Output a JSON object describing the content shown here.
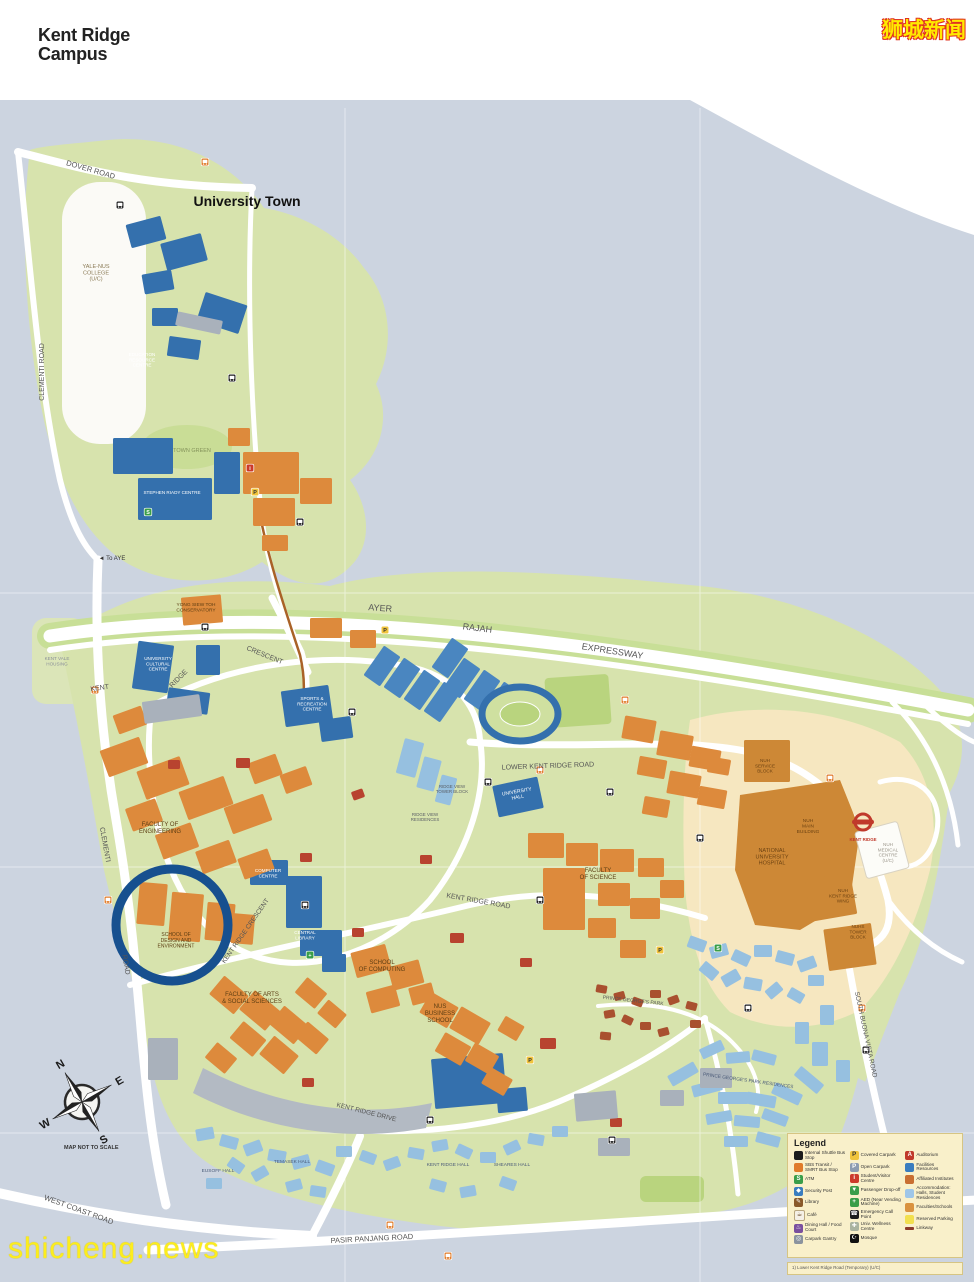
{
  "header": {
    "title_line1": "Kent Ridge",
    "title_line2": "Campus"
  },
  "watermarks": {
    "top_right": "狮城新闻",
    "bottom_left": "shicheng.news"
  },
  "compass": {
    "n": "N",
    "e": "E",
    "w": "W",
    "s": "S",
    "note": "MAP NOT TO SCALE"
  },
  "colors": {
    "water": "#ccd4e0",
    "land_green": "#d7e3ad",
    "field_green": "#b9d47e",
    "nuh_beige": "#f6e7c0",
    "faculty_orange": "#dd8a3c",
    "facility_blue": "#3470ad",
    "residence_blue": "#96c0e0",
    "affiliated_brown": "#cd8836",
    "road_white": "#ffffff",
    "highlight_circle": "#17508f",
    "linkway": "#a96227"
  },
  "map_labels": [
    {
      "t": "University Town",
      "x": 247,
      "y": 206,
      "s": 14,
      "c": "#111111",
      "w": 700
    },
    {
      "t": "DOVER ROAD",
      "x": 90,
      "y": 172,
      "s": 7.5,
      "r": 16,
      "c": "#555555"
    },
    {
      "t": "CLEMENTI ROAD",
      "x": 44,
      "y": 372,
      "s": 7,
      "r": -90,
      "c": "#555555"
    },
    {
      "t": "YALE-NUS\nCOLLEGE\n(U/C)",
      "x": 96,
      "y": 268,
      "s": 5.5,
      "c": "#8a7a55"
    },
    {
      "t": "TOWN GREEN",
      "x": 192,
      "y": 452,
      "s": 5.5,
      "c": "#84935a"
    },
    {
      "t": "STEPHEN RIADY CENTRE",
      "x": 172,
      "y": 494,
      "s": 4.6,
      "c": "#ffffff"
    },
    {
      "t": "EDUCATION\nRESOURCE\nCENTRE",
      "x": 142,
      "y": 356,
      "s": 4.6,
      "c": "#ffffff"
    },
    {
      "t": "YONG SIEW TOH\nCONSERVATORY",
      "x": 196,
      "y": 606,
      "s": 4.8,
      "c": "#5c3d12"
    },
    {
      "t": "◄ To AYE",
      "x": 112,
      "y": 560,
      "s": 6,
      "c": "#333333"
    },
    {
      "t": "AYER",
      "x": 380,
      "y": 611,
      "s": 9,
      "r": 4,
      "c": "#555555"
    },
    {
      "t": "RAJAH",
      "x": 477,
      "y": 631,
      "s": 9,
      "r": 7,
      "c": "#555555"
    },
    {
      "t": "EXPRESSWAY",
      "x": 612,
      "y": 654,
      "s": 9,
      "r": 9,
      "c": "#555555"
    },
    {
      "t": "KENT",
      "x": 100,
      "y": 690,
      "s": 7,
      "r": -8,
      "c": "#555555"
    },
    {
      "t": "RIDGE",
      "x": 180,
      "y": 680,
      "s": 7,
      "r": -45,
      "c": "#555555"
    },
    {
      "t": "CRESCENT",
      "x": 264,
      "y": 657,
      "s": 7,
      "r": 22,
      "c": "#555555"
    },
    {
      "t": "KENT VALE\nHOUSING",
      "x": 57,
      "y": 660,
      "s": 4.6,
      "c": "#8a8f98"
    },
    {
      "t": "UNIVERSITY\nCULTURAL\nCENTRE",
      "x": 158,
      "y": 660,
      "s": 4.6,
      "c": "#ffffff"
    },
    {
      "t": "SPORTS &\nRECREATION\nCENTRE",
      "x": 312,
      "y": 700,
      "s": 4.6,
      "c": "#ffffff"
    },
    {
      "t": "LOWER KENT RIDGE ROAD",
      "x": 548,
      "y": 768,
      "s": 7,
      "r": -2,
      "c": "#555555"
    },
    {
      "t": "UNIVERSITY\nHALL",
      "x": 517,
      "y": 793,
      "s": 5,
      "r": -10,
      "c": "#ffffff"
    },
    {
      "t": "RIDGE VIEW\nTOWER BLOCK",
      "x": 452,
      "y": 788,
      "s": 4.4,
      "c": "#5a5f66"
    },
    {
      "t": "RIDGE VIEW\nRESIDENCES",
      "x": 425,
      "y": 816,
      "s": 4.4,
      "c": "#5a5f66"
    },
    {
      "t": "FACULTY OF\nENGINEERING",
      "x": 160,
      "y": 826,
      "s": 6,
      "c": "#5c3d12"
    },
    {
      "t": "FACULTY\nOF SCIENCE",
      "x": 598,
      "y": 872,
      "s": 6,
      "c": "#5c3d12"
    },
    {
      "t": "NATIONAL\nUNIVERSITY\nHOSPITAL",
      "x": 772,
      "y": 852,
      "s": 5.5,
      "c": "#6e4312"
    },
    {
      "t": "NUH\nMAIN\nBUILDING",
      "x": 808,
      "y": 822,
      "s": 4.8,
      "c": "#6e4312"
    },
    {
      "t": "NUH\nSERVICE\nBLOCK",
      "x": 765,
      "y": 762,
      "s": 4.6,
      "c": "#6e4312"
    },
    {
      "t": "NUH\nMEDICAL\nCENTRE\n(U/C)",
      "x": 888,
      "y": 846,
      "s": 4.6,
      "c": "#9a958a"
    },
    {
      "t": "NUH\nKENT RIDGE\nWING",
      "x": 843,
      "y": 892,
      "s": 4.6,
      "c": "#6e4312"
    },
    {
      "t": "NUHS\nTOWER\nBLOCK",
      "x": 858,
      "y": 928,
      "s": 4.6,
      "c": "#6e4312"
    },
    {
      "t": "KENT RIDGE",
      "x": 863,
      "y": 841,
      "s": 4.4,
      "c": "#c0392b",
      "w": 700
    },
    {
      "t": "SCHOOL OF\nDESIGN AND\nENVIRONMENT",
      "x": 176,
      "y": 936,
      "s": 5,
      "c": "#5c3d12"
    },
    {
      "t": "COMPUTER\nCENTRE",
      "x": 268,
      "y": 872,
      "s": 4.6,
      "c": "#ffffff"
    },
    {
      "t": "CENTRAL\nLIBRARY",
      "x": 305,
      "y": 934,
      "s": 4.6,
      "c": "#ffffff"
    },
    {
      "t": "KENT RIDGE CRESCENT",
      "x": 247,
      "y": 932,
      "s": 6.5,
      "r": -55,
      "c": "#555555"
    },
    {
      "t": "FACULTY OF ARTS\n& SOCIAL SCIENCES",
      "x": 252,
      "y": 996,
      "s": 6,
      "c": "#5c3d12"
    },
    {
      "t": "SCHOOL\nOF COMPUTING",
      "x": 382,
      "y": 964,
      "s": 6,
      "c": "#5c3d12"
    },
    {
      "t": "NUS\nBUSINESS\nSCHOOL",
      "x": 440,
      "y": 1008,
      "s": 6,
      "c": "#5c3d12"
    },
    {
      "t": "KENT RIDGE ROAD",
      "x": 478,
      "y": 903,
      "s": 7,
      "r": 10,
      "c": "#555555"
    },
    {
      "t": "KENT RIDGE DRIVE",
      "x": 366,
      "y": 1114,
      "s": 6.5,
      "r": 14,
      "c": "#555555"
    },
    {
      "t": "PRINCE GEORGE'S PARK",
      "x": 633,
      "y": 1002,
      "s": 5,
      "r": 6,
      "c": "#555555"
    },
    {
      "t": "PRINCE GEORGE'S PARK RESIDENCES",
      "x": 748,
      "y": 1082,
      "s": 4.8,
      "r": 8,
      "c": "#4a5a78"
    },
    {
      "t": "SOUTH BUONA VISTA ROAD",
      "x": 864,
      "y": 1035,
      "s": 6.5,
      "r": 78,
      "c": "#555555"
    },
    {
      "t": "EUSOFF HALL",
      "x": 218,
      "y": 1172,
      "s": 4.8,
      "c": "#4a5a78"
    },
    {
      "t": "TEMASEK HALL",
      "x": 292,
      "y": 1163,
      "s": 4.8,
      "c": "#4a5a78"
    },
    {
      "t": "KENT RIDGE HALL",
      "x": 448,
      "y": 1166,
      "s": 4.8,
      "c": "#4a5a78"
    },
    {
      "t": "SHEARES HALL",
      "x": 512,
      "y": 1166,
      "s": 4.8,
      "c": "#4a5a78"
    },
    {
      "t": "WEST COAST ROAD",
      "x": 78,
      "y": 1212,
      "s": 7.5,
      "r": 20,
      "c": "#555555"
    },
    {
      "t": "PASIR PANJANG ROAD",
      "x": 372,
      "y": 1241,
      "s": 7.5,
      "r": -3,
      "c": "#555555"
    },
    {
      "t": "CLEMENTI",
      "x": 103,
      "y": 845,
      "s": 7,
      "r": 80,
      "c": "#555555"
    },
    {
      "t": "ROAD",
      "x": 124,
      "y": 965,
      "s": 7,
      "r": 80,
      "c": "#555555"
    }
  ],
  "map_icons": [
    {
      "t": "shuttle-bus-stop",
      "x": 120,
      "y": 205,
      "c": "#1c1c1c"
    },
    {
      "t": "shuttle-bus-stop",
      "x": 232,
      "y": 378,
      "c": "#1c1c1c"
    },
    {
      "t": "shuttle-bus-stop",
      "x": 300,
      "y": 522,
      "c": "#1c1c1c"
    },
    {
      "t": "shuttle-bus-stop",
      "x": 205,
      "y": 627,
      "c": "#1c1c1c"
    },
    {
      "t": "shuttle-bus-stop",
      "x": 352,
      "y": 712,
      "c": "#1c1c1c"
    },
    {
      "t": "shuttle-bus-stop",
      "x": 488,
      "y": 782,
      "c": "#1c1c1c"
    },
    {
      "t": "shuttle-bus-stop",
      "x": 610,
      "y": 792,
      "c": "#1c1c1c"
    },
    {
      "t": "shuttle-bus-stop",
      "x": 700,
      "y": 838,
      "c": "#1c1c1c"
    },
    {
      "t": "shuttle-bus-stop",
      "x": 540,
      "y": 900,
      "c": "#1c1c1c"
    },
    {
      "t": "shuttle-bus-stop",
      "x": 430,
      "y": 1120,
      "c": "#1c1c1c"
    },
    {
      "t": "shuttle-bus-stop",
      "x": 612,
      "y": 1140,
      "c": "#1c1c1c"
    },
    {
      "t": "shuttle-bus-stop",
      "x": 748,
      "y": 1008,
      "c": "#1c1c1c"
    },
    {
      "t": "shuttle-bus-stop",
      "x": 866,
      "y": 1050,
      "c": "#1c1c1c"
    },
    {
      "t": "shuttle-bus-stop",
      "x": 305,
      "y": 905,
      "c": "#1c1c1c"
    },
    {
      "t": "public-bus-stop",
      "x": 205,
      "y": 162,
      "c": "#e07b2a"
    },
    {
      "t": "public-bus-stop",
      "x": 95,
      "y": 690,
      "c": "#e07b2a"
    },
    {
      "t": "public-bus-stop",
      "x": 540,
      "y": 770,
      "c": "#e07b2a"
    },
    {
      "t": "public-bus-stop",
      "x": 830,
      "y": 778,
      "c": "#e07b2a"
    },
    {
      "t": "public-bus-stop",
      "x": 862,
      "y": 1008,
      "c": "#e07b2a"
    },
    {
      "t": "public-bus-stop",
      "x": 390,
      "y": 1225,
      "c": "#e07b2a"
    },
    {
      "t": "public-bus-stop",
      "x": 448,
      "y": 1256,
      "c": "#e07b2a"
    },
    {
      "t": "public-bus-stop",
      "x": 625,
      "y": 700,
      "c": "#e07b2a"
    },
    {
      "t": "public-bus-stop",
      "x": 108,
      "y": 900,
      "c": "#e07b2a"
    },
    {
      "t": "covered-carpark",
      "x": 385,
      "y": 630,
      "c": "#f0c43c",
      "g": "P",
      "gc": "#333333"
    },
    {
      "t": "covered-carpark",
      "x": 255,
      "y": 492,
      "c": "#f0c43c",
      "g": "P",
      "gc": "#333333"
    },
    {
      "t": "covered-carpark",
      "x": 530,
      "y": 1060,
      "c": "#f0c43c",
      "g": "P",
      "gc": "#333333"
    },
    {
      "t": "covered-carpark",
      "x": 660,
      "y": 950,
      "c": "#f0c43c",
      "g": "P",
      "gc": "#333333"
    },
    {
      "t": "visitor-centre",
      "x": 250,
      "y": 468,
      "c": "#cc3a2a",
      "g": "i",
      "gc": "#ffffff"
    },
    {
      "t": "atm",
      "x": 148,
      "y": 512,
      "c": "#3a9e49",
      "g": "S",
      "gc": "#ffffff"
    },
    {
      "t": "atm",
      "x": 718,
      "y": 948,
      "c": "#3a9e49",
      "g": "S",
      "gc": "#ffffff"
    },
    {
      "t": "aed",
      "x": 310,
      "y": 955,
      "c": "#3a9e49",
      "g": "+",
      "gc": "#ffffff"
    }
  ],
  "legend": {
    "title": "Legend",
    "columns": [
      [
        {
          "type": "icon",
          "color": "#1c1c1c",
          "glyph": "",
          "glyph_color": "#ffffff",
          "label": "Internal Shuttle Bus Stop",
          "name": "shuttle-bus-icon"
        },
        {
          "type": "icon",
          "color": "#e07b2a",
          "glyph": "",
          "glyph_color": "#ffffff",
          "label": "SBS Transit / SMRT Bus Stop",
          "name": "public-bus-icon"
        },
        {
          "type": "icon",
          "color": "#3a9e49",
          "glyph": "S",
          "glyph_color": "#ffffff",
          "label": "ATM",
          "name": "atm-icon"
        },
        {
          "type": "icon",
          "color": "#3a7dbf",
          "glyph": "◆",
          "glyph_color": "#ffffff",
          "label": "Security Post",
          "name": "security-post-icon"
        },
        {
          "type": "icon",
          "color": "#8a5a2b",
          "glyph": "✎",
          "glyph_color": "#ffffff",
          "label": "Library",
          "name": "library-icon"
        },
        {
          "type": "icon",
          "color": "#f5f0e6",
          "glyph": "☕",
          "glyph_color": "#6b4a2a",
          "label": "Café",
          "name": "cafe-icon"
        },
        {
          "type": "icon",
          "color": "#7a4f9e",
          "glyph": "♨",
          "glyph_color": "#ffffff",
          "label": "Dining Hall / Food Court",
          "name": "dining-icon"
        },
        {
          "type": "icon",
          "color": "#8b939e",
          "glyph": "◎",
          "glyph_color": "#ffffff",
          "label": "Carpark Gantry",
          "name": "gantry-icon"
        }
      ],
      [
        {
          "type": "icon",
          "color": "#f0c43c",
          "glyph": "P",
          "glyph_color": "#333333",
          "label": "Covered Carpark",
          "name": "covered-carpark-icon"
        },
        {
          "type": "icon",
          "color": "#8c9bb0",
          "glyph": "P",
          "glyph_color": "#ffffff",
          "label": "Open Carpark",
          "name": "open-carpark-icon"
        },
        {
          "type": "icon",
          "color": "#cc3a2a",
          "glyph": "i",
          "glyph_color": "#ffffff",
          "label": "Student/Visitor Centre",
          "name": "visitor-centre-icon"
        },
        {
          "type": "icon",
          "color": "#3a9e49",
          "glyph": "▼",
          "glyph_color": "#ffffff",
          "label": "Passenger Drop-off",
          "name": "drop-off-icon"
        },
        {
          "type": "icon",
          "color": "#3a9e49",
          "glyph": "+",
          "glyph_color": "#ffffff",
          "label": "AED (Near Vending Machine)",
          "name": "aed-icon"
        },
        {
          "type": "icon",
          "color": "#1c1c1c",
          "glyph": "☎",
          "glyph_color": "#ffffff",
          "label": "Emergency Call Point",
          "name": "emergency-call-icon"
        },
        {
          "type": "icon",
          "color": "#aab3a0",
          "glyph": "✚",
          "glyph_color": "#ffffff",
          "label": "Univ. Wellness Centre",
          "name": "wellness-centre-icon"
        },
        {
          "type": "icon",
          "color": "#111111",
          "glyph": "☪",
          "glyph_color": "#ffffff",
          "label": "Mosque",
          "name": "mosque-icon"
        }
      ],
      [
        {
          "type": "icon",
          "color": "#c0392b",
          "glyph": "A",
          "glyph_color": "#ffffff",
          "label": "Auditorium",
          "name": "auditorium-icon"
        },
        {
          "type": "swatch",
          "color": "#3a7dbf",
          "label": "Facilities Resources",
          "name": "facilities-swatch"
        },
        {
          "type": "swatch",
          "color": "#c96f32",
          "label": "Affiliated Institutes",
          "name": "affiliated-swatch"
        },
        {
          "type": "swatch",
          "color": "#9fc6e8",
          "label": "Accommodation: Halls, Student Residences",
          "name": "accommodation-swatch"
        },
        {
          "type": "swatch",
          "color": "#d9923f",
          "label": "Faculties/Schools",
          "name": "faculties-swatch"
        },
        {
          "type": "swatch",
          "color": "#f2e04e",
          "label": "Reserved Parking",
          "name": "reserved-parking-swatch"
        },
        {
          "type": "line",
          "color": "#8b3a2a",
          "label": "Linkway",
          "name": "linkway-swatch"
        }
      ]
    ],
    "footnote": "1) Lower Kent Ridge Road (Temporary) (U/C)"
  }
}
